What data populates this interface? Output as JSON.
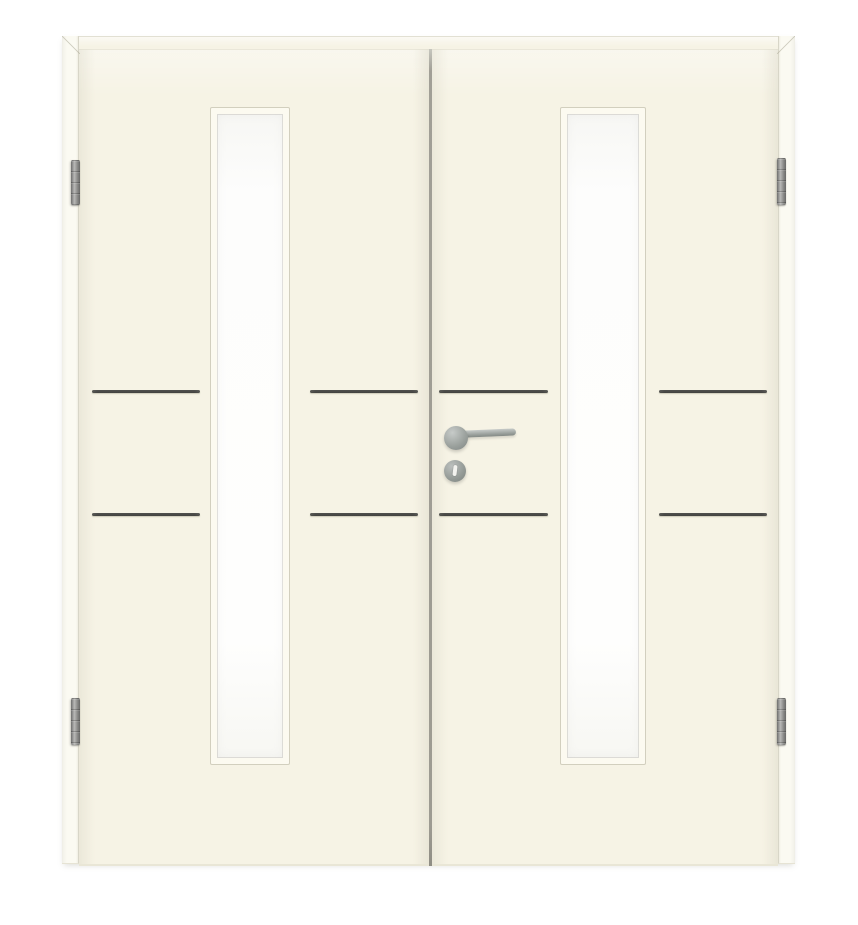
{
  "scene": {
    "description": "Cream white double interior door with frame, narrow vertical glazing cutout in each leaf, stainless steel horizontal inlay strips, lever handle on round rosette with keyhole escutcheon, and four hinges",
    "background_color": "#ffffff"
  },
  "door": {
    "finish_color": "#f6f3e5",
    "frame_color": "#fbf9f0",
    "bead_color": "#fcfaf0",
    "glass_color": "#fdfdfc",
    "inlay_color": "#868684",
    "hardware_color": "#9ba19d",
    "leaf_count": 2,
    "glass_panels": 2,
    "inlay_strips": 8,
    "hinges": 4,
    "handle_type": "lever-on-rosette",
    "lock_type": "keyhole-rosette"
  }
}
